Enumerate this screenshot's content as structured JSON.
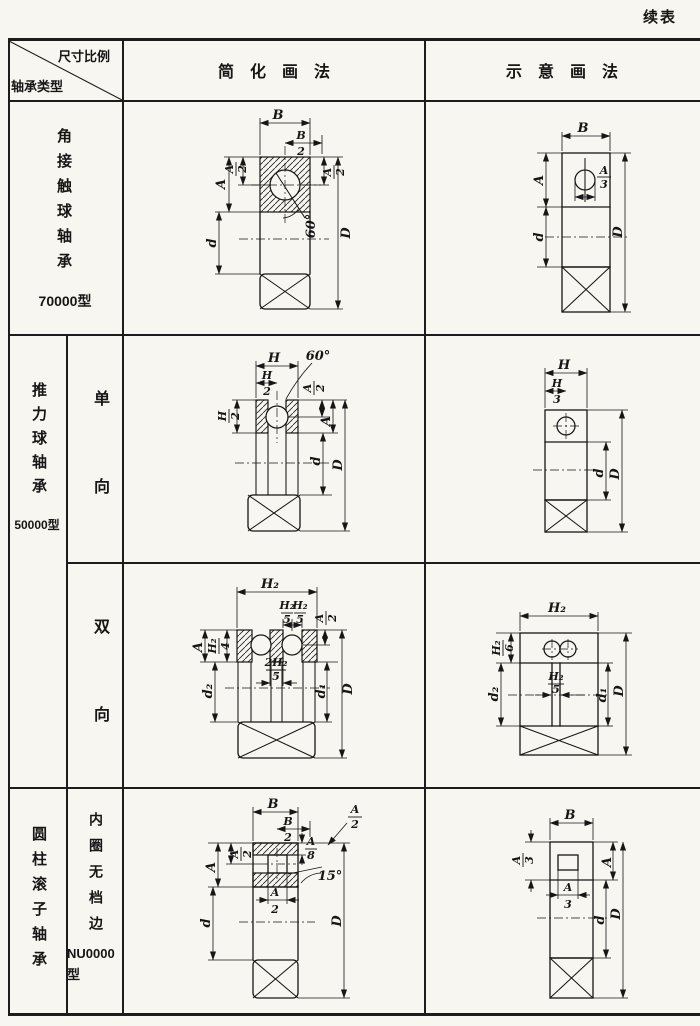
{
  "page": {
    "continued": "续表"
  },
  "header": {
    "corner_top": "尺寸比例",
    "corner_bottom": "轴承类型",
    "col_simplified": "简化画法",
    "col_schematic": "示意画法"
  },
  "row1": {
    "type": "角接触球轴承",
    "model": "70000型"
  },
  "row2": {
    "type": "推力球轴承",
    "model": "50000型",
    "sub_single": "单向",
    "sub_double": "双向"
  },
  "row3": {
    "type": "圆柱滚子轴承",
    "sub": "内圈无档边",
    "model": "NU0000型"
  },
  "dwg": {
    "r1_simple": {
      "B": "B",
      "B2n": "B",
      "B2d": "2",
      "A": "A",
      "A2ln": "A",
      "A2ld": "2",
      "A2rn": "A",
      "A2rd": "2",
      "angle": "60°",
      "d": "d",
      "D": "D"
    },
    "r1_schem": {
      "B": "B",
      "A": "A",
      "A3n": "A",
      "A3d": "3",
      "d": "d",
      "D": "D"
    },
    "r2a_simple": {
      "H": "H",
      "H2tn": "H",
      "H2td": "2",
      "H2ln": "H",
      "H2ld": "2",
      "angle": "60°",
      "A2n": "A",
      "A2d": "2",
      "A": "A",
      "d": "d",
      "D": "D"
    },
    "r2a_schem": {
      "H": "H",
      "H3n": "H",
      "H3d": "3",
      "d": "d",
      "D": "D"
    },
    "r2b_simple": {
      "H2": "H₂",
      "H25an": "H₂",
      "H25ad": "5",
      "H25bn": "H₂",
      "H25bd": "5",
      "A2n": "A",
      "A2d": "2",
      "A": "A",
      "H24n": "H₂",
      "H24d": "4",
      "midn": "2H₂",
      "midd": "5",
      "d2": "d₂",
      "d1": "d₁",
      "D": "D"
    },
    "r2b_schem": {
      "H2": "H₂",
      "H26n": "H₂",
      "H26d": "6",
      "H25n": "H₂",
      "H25d": "5",
      "d2": "d₂",
      "d1": "d₁",
      "D": "D"
    },
    "r3_simple": {
      "B": "B",
      "B2n": "B",
      "B2d": "2",
      "A8n": "A",
      "A8d": "8",
      "A2tn": "A",
      "A2td": "2",
      "angle": "15°",
      "A": "A",
      "A2ln": "A",
      "A2ld": "2",
      "A2bn": "A",
      "A2bd": "2",
      "d": "d",
      "D": "D"
    },
    "r3_schem": {
      "B": "B",
      "A3ln": "A",
      "A3ld": "3",
      "A": "A",
      "A3bn": "A",
      "A3bd": "3",
      "d": "d",
      "D": "D"
    }
  }
}
